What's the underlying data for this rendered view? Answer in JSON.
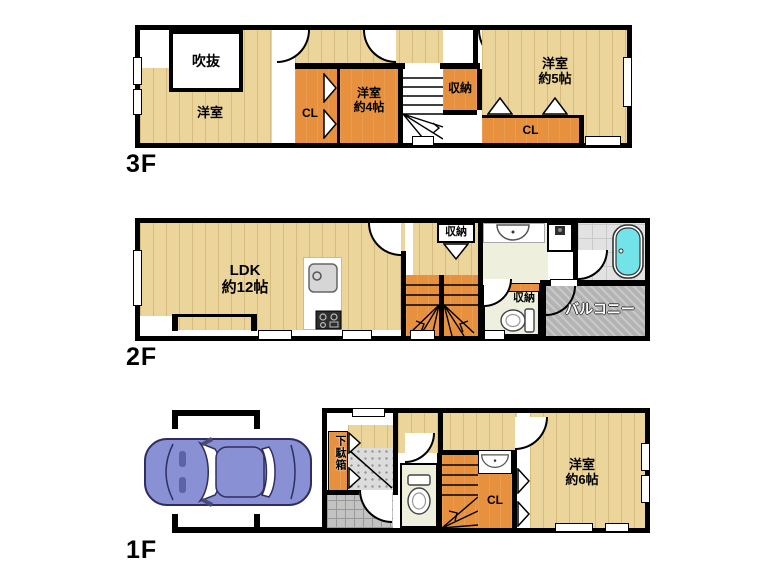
{
  "title": "3-story house floor plan",
  "colors": {
    "wood_floor": "#ecd59b",
    "closet_orange": "#e7913f",
    "pale_room": "#eef0dd",
    "bath_tile": "#e2e2e2",
    "bathtub_cyan": "#72e4e9",
    "balcony_gray": "#b3b3b3",
    "car_body": "#8a90d4",
    "wall_black": "#000000"
  },
  "floor3": {
    "label": "3F",
    "rooms": {
      "fukinuke": "吹抜",
      "youshitsu": "洋室",
      "cl_left": "CL",
      "youshitsu4_l1": "洋室",
      "youshitsu4_l2": "約4帖",
      "shuno": "収納",
      "youshitsu5_l1": "洋室",
      "youshitsu5_l2": "約5帖",
      "cl_right": "CL"
    }
  },
  "floor2": {
    "label": "2F",
    "rooms": {
      "ldk_l1": "LDK",
      "ldk_l2": "約12帖",
      "shuno_top": "収納",
      "shuno_mid": "収納",
      "balcony": "バルコニー"
    }
  },
  "floor1": {
    "label": "1F",
    "rooms": {
      "getabako": "下駄箱",
      "cl": "CL",
      "youshitsu6_l1": "洋室",
      "youshitsu6_l2": "約6帖"
    }
  }
}
